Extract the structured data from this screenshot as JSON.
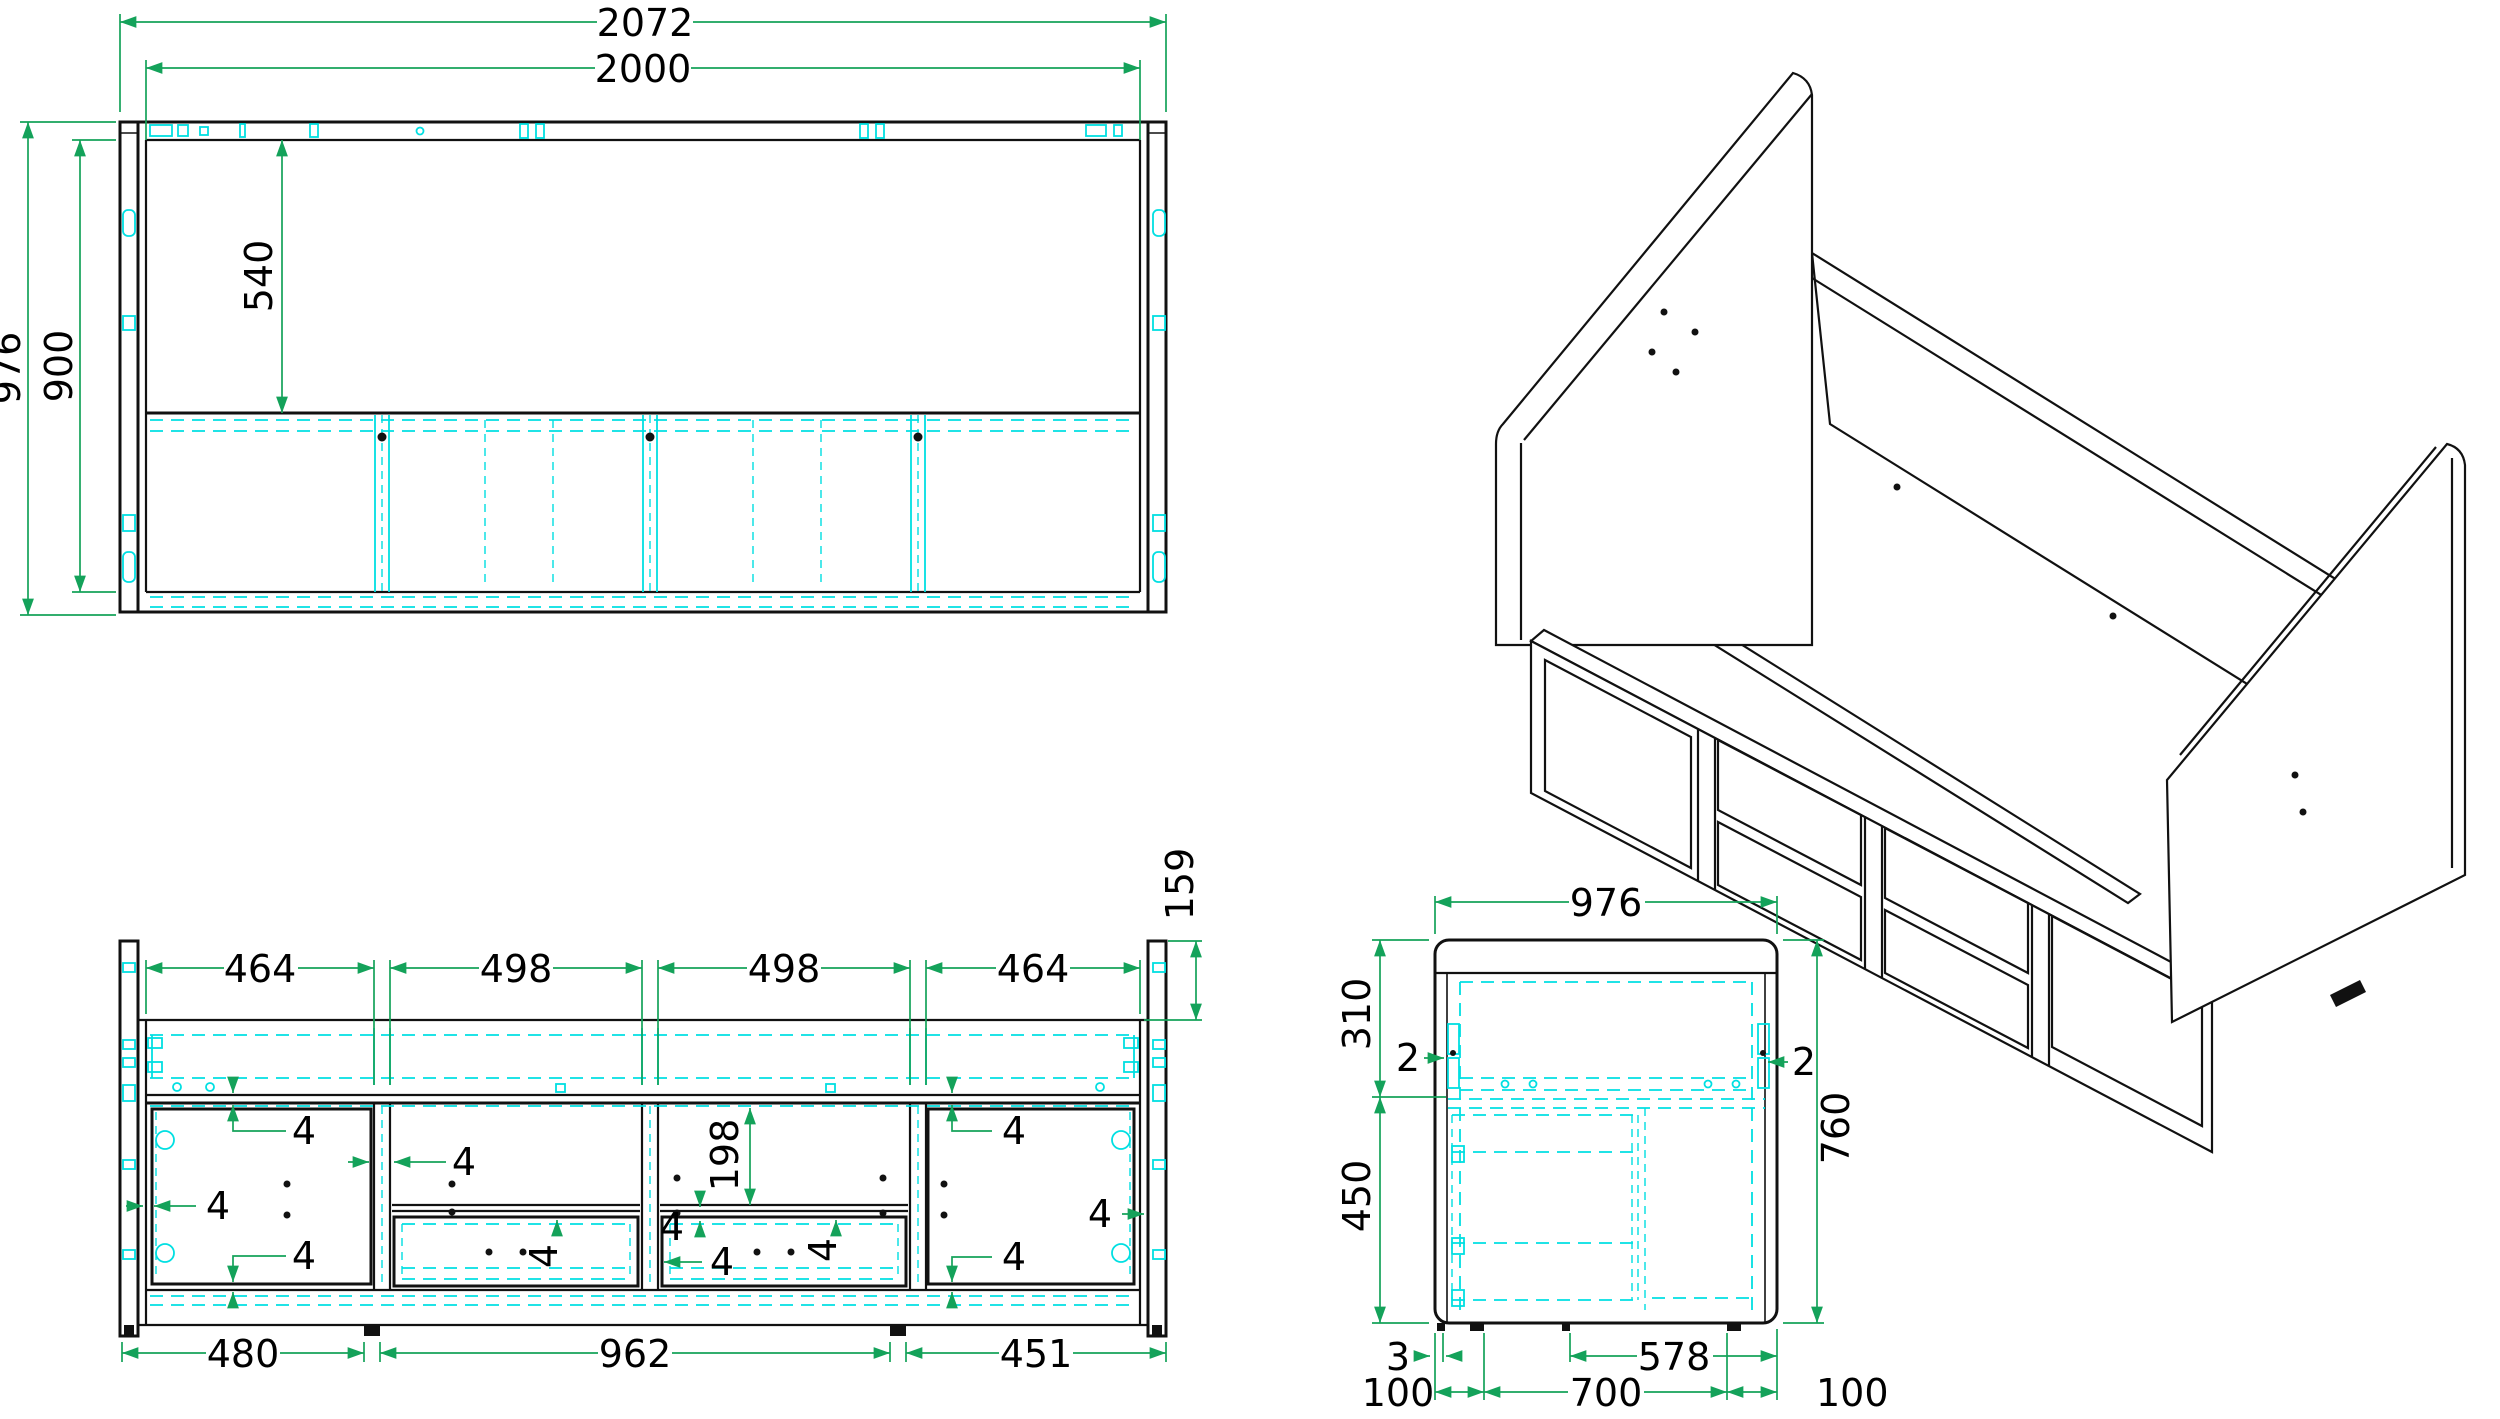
{
  "drawing": {
    "front": {
      "w_all": "2072",
      "w_in": "2000",
      "h_all": "976",
      "h_in": "900",
      "rail_shelf": "540"
    },
    "rear": {
      "top": [
        "464",
        "498",
        "498",
        "464"
      ],
      "post_top": "159",
      "cubby_h": "198",
      "gap": "4",
      "bottom": [
        "480",
        "962",
        "451"
      ]
    },
    "side": {
      "depth": "976",
      "upper": "310",
      "lower": "450",
      "total": "760",
      "gap_l": "2",
      "gap_r": "2",
      "foot_gap": "3",
      "b": [
        "100",
        "700",
        "578",
        "100"
      ]
    },
    "colors": {
      "dimension": "#14a25a",
      "hidden": "#00dfe2",
      "outline": "#111111"
    }
  }
}
